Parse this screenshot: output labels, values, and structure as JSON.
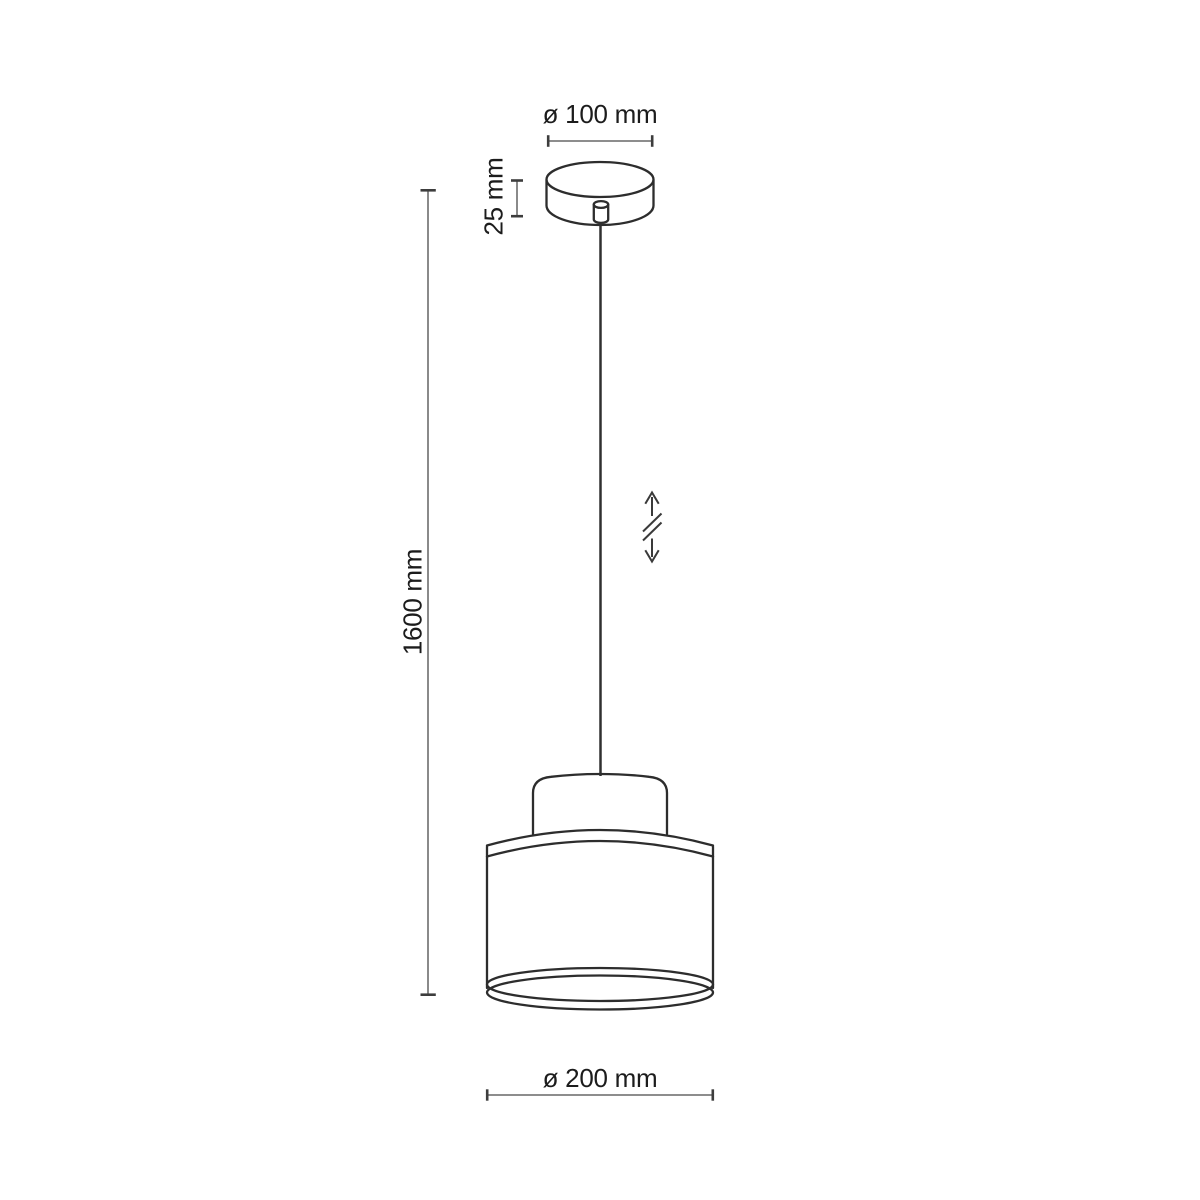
{
  "diagram": {
    "type": "technical-dimension-drawing",
    "subject": "pendant-lamp",
    "labels": {
      "canopy_diameter": "ø 100 mm",
      "canopy_height": "25 mm",
      "total_height": "1600 mm",
      "shade_diameter": "ø 200 mm"
    },
    "values_mm": {
      "canopy_diameter": 100,
      "canopy_height": 25,
      "total_height": 1600,
      "shade_diameter": 200
    },
    "icons": {
      "height_adjustable": "vertical-double-arrow-with-break"
    },
    "colors": {
      "outline": "#2d2d2d",
      "cable": "#303030",
      "dimension_line": "#7d7d7d",
      "dimension_tick": "#3d3d3d",
      "icon": "#3a3a3a",
      "text": "#1c1c1c",
      "background": "#ffffff"
    }
  }
}
